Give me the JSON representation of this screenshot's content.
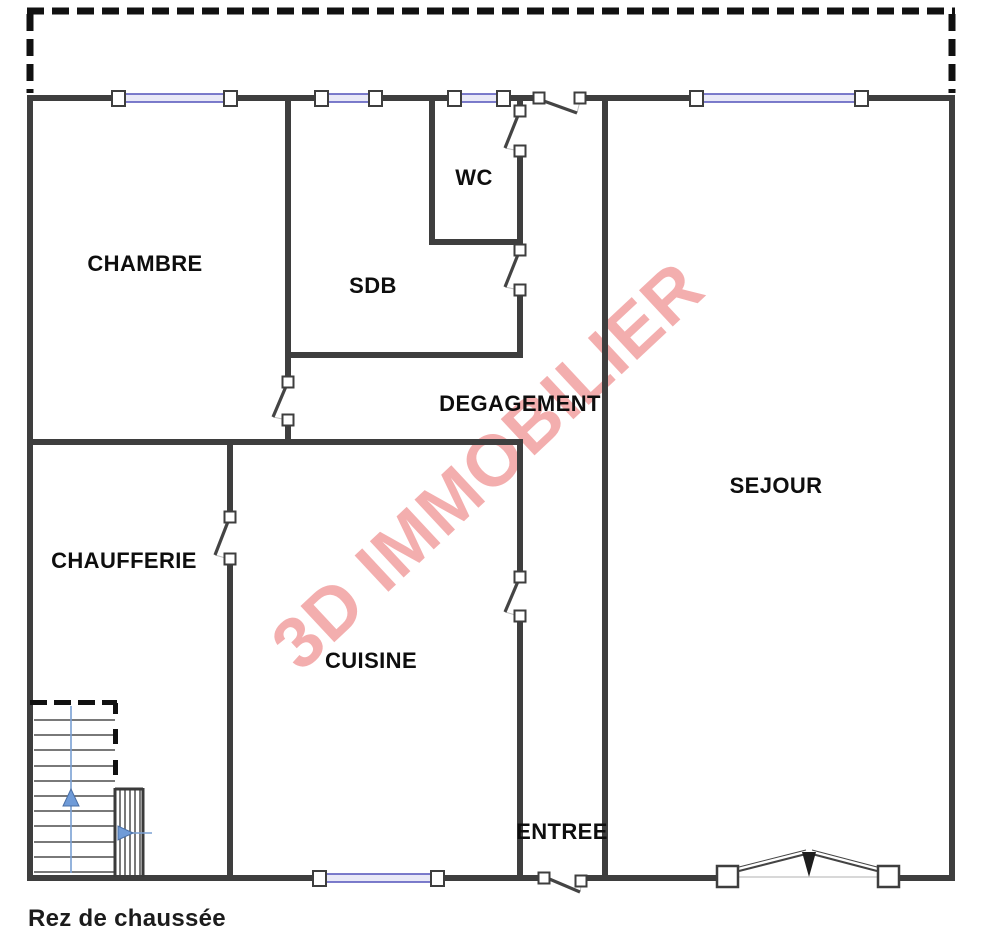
{
  "title": {
    "caption": "Rez de chaussée"
  },
  "watermark": {
    "text": "3D IMMOBILIER",
    "color": "#ef9090",
    "rotation_deg": -43
  },
  "rooms": [
    {
      "id": "chambre",
      "name": "CHAMBRE",
      "x": 145,
      "y": 264
    },
    {
      "id": "sdb",
      "name": "SDB",
      "x": 373,
      "y": 286
    },
    {
      "id": "wc",
      "name": "WC",
      "x": 474,
      "y": 178
    },
    {
      "id": "degagement",
      "name": "DEGAGEMENT",
      "x": 520,
      "y": 404
    },
    {
      "id": "sejour",
      "name": "SEJOUR",
      "x": 776,
      "y": 486
    },
    {
      "id": "chaufferie",
      "name": "CHAUFFERIE",
      "x": 124,
      "y": 561
    },
    {
      "id": "cuisine",
      "name": "CUISINE",
      "x": 371,
      "y": 661
    },
    {
      "id": "entree",
      "name": "ENTREE",
      "x": 562,
      "y": 832
    }
  ],
  "plan": {
    "width": 985,
    "height": 937,
    "colors": {
      "wall": "#3e3e3e",
      "dashed": "#111111",
      "window_line": "#5d5dbe",
      "window_fill": "#e9e9f7",
      "hinge_fill": "#ffffff",
      "leaf": "#444444",
      "chord": "#bdbdbd",
      "stair_line": "#4d4d4d",
      "stair_edge": "#3a3a3a",
      "arrow_line": "#7aa0d4",
      "arrow_fill": "#6f9bd8",
      "arrow_stroke": "#4a6fa5",
      "wedge": "#1d1d1d",
      "threshold": "#d8d8d8"
    },
    "dashed_boundary": [
      [
        27,
        11,
        955,
        11
      ],
      [
        30,
        14,
        30,
        93
      ],
      [
        952,
        14,
        952,
        93
      ]
    ],
    "walls": [
      [
        27,
        95,
        513,
        6
      ],
      [
        577,
        95,
        378,
        6
      ],
      [
        27,
        95,
        6,
        786
      ],
      [
        949,
        95,
        6,
        786
      ],
      [
        27,
        875,
        519,
        6
      ],
      [
        579,
        875,
        140,
        6
      ],
      [
        898,
        875,
        57,
        6
      ],
      [
        285,
        95,
        6,
        285
      ],
      [
        285,
        420,
        6,
        25
      ],
      [
        285,
        352,
        238,
        6
      ],
      [
        429,
        95,
        6,
        150
      ],
      [
        429,
        239,
        94,
        6
      ],
      [
        517,
        95,
        6,
        17
      ],
      [
        517,
        150,
        6,
        97
      ],
      [
        517,
        292,
        6,
        66
      ],
      [
        517,
        442,
        6,
        133
      ],
      [
        517,
        618,
        6,
        259
      ],
      [
        602,
        95,
        6,
        786
      ],
      [
        27,
        439,
        496,
        6
      ],
      [
        227,
        445,
        6,
        70
      ],
      [
        227,
        562,
        6,
        315
      ]
    ],
    "windows": [
      [
        112,
        98,
        125
      ],
      [
        315,
        98,
        67
      ],
      [
        448,
        98,
        62
      ],
      [
        690,
        98,
        178
      ],
      [
        313,
        878,
        131
      ]
    ],
    "doors": [
      {
        "id": "top-entry-door",
        "hinges": [
          [
            539,
            98
          ],
          [
            580,
            98
          ]
        ],
        "leaf": [
          541,
          100,
          577,
          113
        ],
        "chord": [
          577,
          113,
          580,
          101
        ]
      },
      {
        "id": "wc-door",
        "hinges": [
          [
            520,
            111
          ],
          [
            520,
            151
          ]
        ],
        "leaf": [
          519,
          113,
          505,
          148
        ],
        "chord": [
          505,
          148,
          519,
          151
        ]
      },
      {
        "id": "sdb-door",
        "hinges": [
          [
            520,
            250
          ],
          [
            520,
            290
          ]
        ],
        "leaf": [
          519,
          252,
          505,
          287
        ],
        "chord": [
          505,
          287,
          519,
          290
        ]
      },
      {
        "id": "chambre-door",
        "hinges": [
          [
            288,
            382
          ],
          [
            288,
            420
          ]
        ],
        "leaf": [
          287,
          384,
          273,
          417
        ],
        "chord": [
          273,
          417,
          287,
          420
        ]
      },
      {
        "id": "chaufferie-door",
        "hinges": [
          [
            230,
            517
          ],
          [
            230,
            559
          ]
        ],
        "leaf": [
          229,
          519,
          215,
          555
        ],
        "chord": [
          215,
          555,
          229,
          559
        ]
      },
      {
        "id": "cuisine-door",
        "hinges": [
          [
            520,
            577
          ],
          [
            520,
            616
          ]
        ],
        "leaf": [
          519,
          579,
          505,
          612
        ],
        "chord": [
          505,
          612,
          519,
          616
        ]
      },
      {
        "id": "main-entry-door",
        "hinges": [
          [
            544,
            878
          ],
          [
            581,
            881
          ]
        ],
        "leaf": [
          547,
          878,
          580,
          892
        ],
        "chord": [
          580,
          892,
          582,
          881
        ]
      }
    ],
    "french_door": {
      "plates": [
        [
          717,
          866,
          21,
          21
        ],
        [
          878,
          866,
          21,
          21
        ]
      ],
      "leaves": [
        [
          739,
          871,
          806,
          854
        ],
        [
          877,
          871,
          812,
          854
        ]
      ],
      "wedge": [
        [
          802,
          852
        ],
        [
          816,
          852
        ],
        [
          809,
          877
        ]
      ],
      "threshold": [
        738,
        877,
        878,
        877
      ]
    },
    "stairs": {
      "lines": [
        [
          34,
          720,
          115,
          720
        ],
        [
          34,
          735,
          115,
          735
        ],
        [
          34,
          750,
          115,
          750
        ],
        [
          34,
          766,
          115,
          766
        ],
        [
          34,
          781,
          115,
          781
        ],
        [
          34,
          796,
          115,
          796
        ],
        [
          34,
          811,
          115,
          811
        ],
        [
          34,
          826,
          115,
          826
        ],
        [
          34,
          842,
          115,
          842
        ],
        [
          34,
          857,
          115,
          857
        ],
        [
          34,
          872,
          115,
          872
        ],
        [
          120,
          790,
          120,
          875
        ],
        [
          125,
          790,
          125,
          875
        ],
        [
          130,
          790,
          130,
          875
        ],
        [
          135,
          790,
          135,
          875
        ],
        [
          140,
          790,
          140,
          875
        ]
      ],
      "edges": [
        [
          115,
          788,
          115,
          877
        ],
        [
          143,
          788,
          143,
          877
        ],
        [
          115,
          789,
          143,
          789
        ]
      ],
      "dashes": [
        [
          30,
          700,
          17,
          5
        ],
        [
          54,
          700,
          17,
          5
        ],
        [
          78,
          700,
          17,
          5
        ],
        [
          102,
          700,
          15,
          5
        ],
        [
          113,
          703,
          5,
          11
        ],
        [
          113,
          729,
          5,
          15
        ],
        [
          113,
          760,
          5,
          15
        ]
      ]
    },
    "arrows": [
      {
        "id": "stairs-up-arrow",
        "line": [
          71,
          706,
          71,
          873
        ],
        "tri": [
          [
            71,
            789
          ],
          [
            63,
            806
          ],
          [
            79,
            806
          ]
        ]
      },
      {
        "id": "stairs-right-arrow",
        "line": [
          131,
          833,
          152,
          833
        ],
        "tri": [
          [
            133,
            833
          ],
          [
            118,
            826
          ],
          [
            118,
            840
          ]
        ]
      }
    ]
  }
}
